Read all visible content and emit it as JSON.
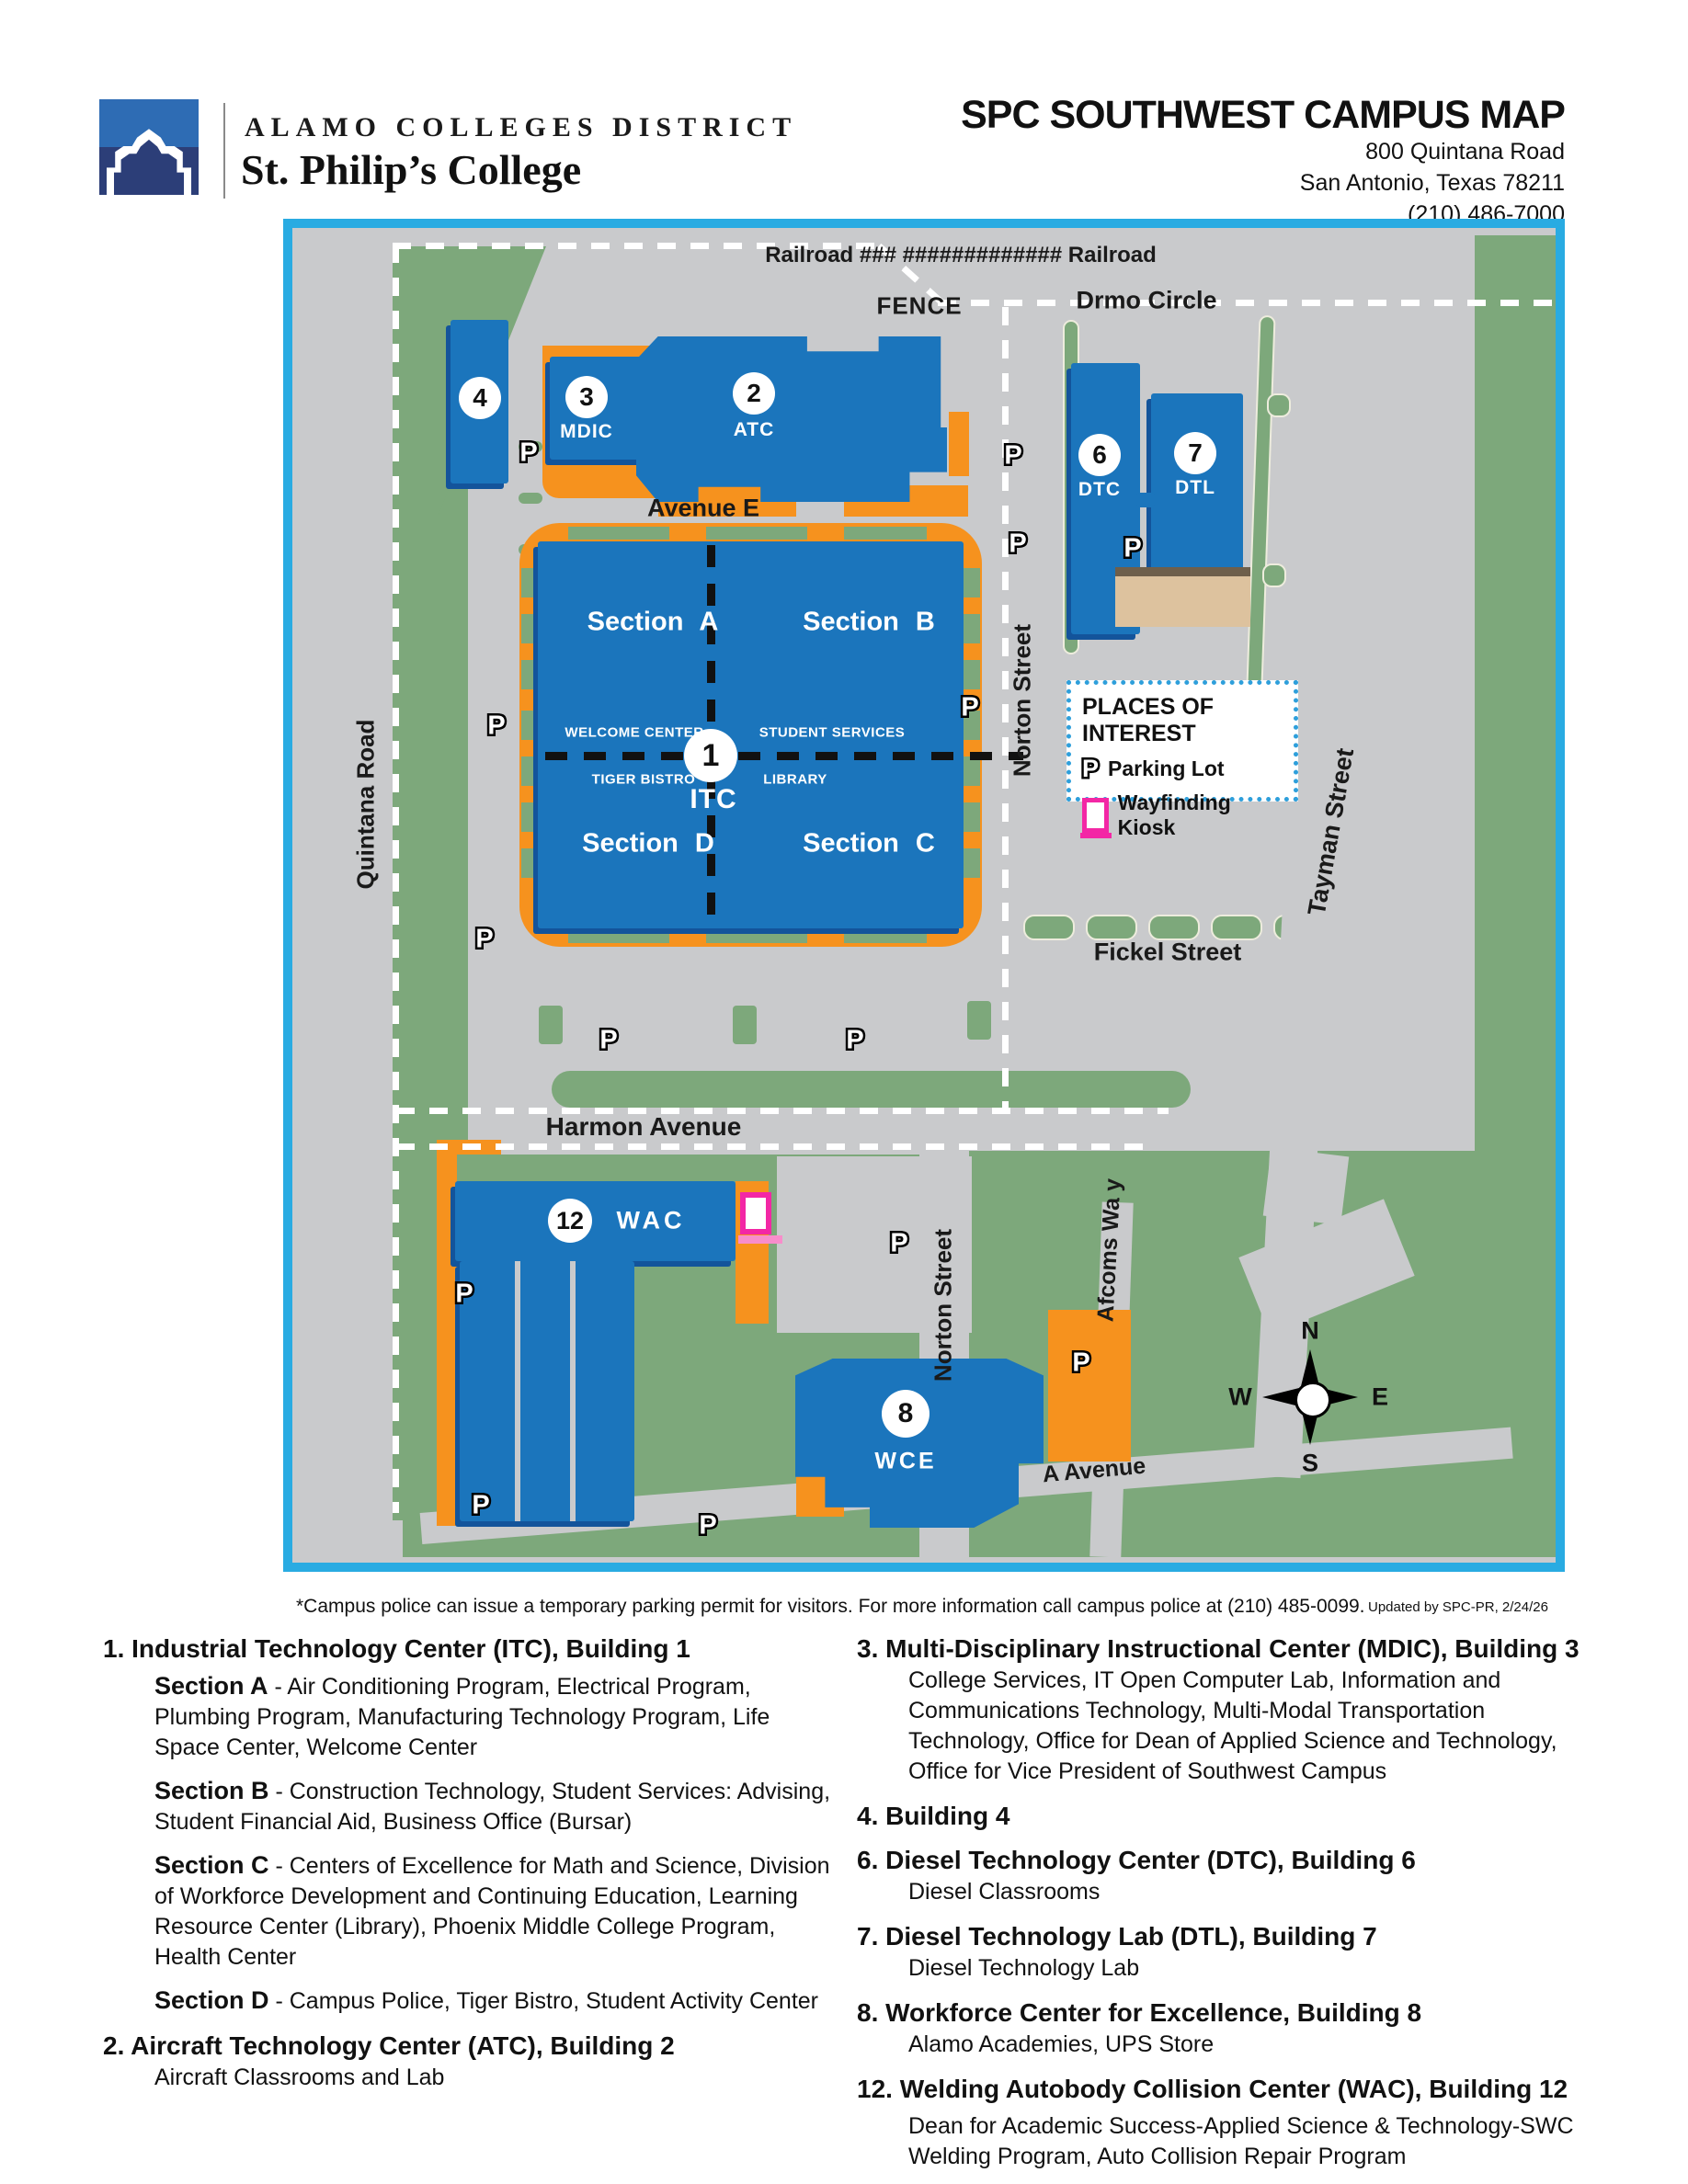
{
  "header": {
    "district": "ALAMO COLLEGES DISTRICT",
    "college": "St. Philip’s College",
    "title": "SPC SOUTHWEST CAMPUS MAP",
    "address_line1": "800 Quintana Road",
    "address_line2": "San Antonio, Texas 78211",
    "address_line3": "(210) 486-7000"
  },
  "map": {
    "p_label": "P",
    "labels": {
      "railroad": "Railroad ### #############   Railroad",
      "fence": "FENCE",
      "drmo_circle": "Drmo Circle",
      "avenue_e": "Avenue  E",
      "quintana_road": "Quintana Road",
      "norton_street_top": "Norton Street",
      "tayman_street": "Tayman Street",
      "fickel_street": "Fickel Street",
      "harmon_avenue": "Harmon Avenue",
      "norton_street_bottom": "Norton Street",
      "afcoms_way": "Afcoms Wa y",
      "a_avenue": "A Avenue"
    },
    "buildings": {
      "b4": {
        "number": "4"
      },
      "mdic": {
        "number": "3",
        "code": "MDIC"
      },
      "atc": {
        "number": "2",
        "code": "ATC"
      },
      "dtc": {
        "number": "6",
        "code": "DTC"
      },
      "dtl": {
        "number": "7",
        "code": "DTL"
      },
      "itc": {
        "number": "1",
        "code": "ITC",
        "section_a": "Section A",
        "section_b": "Section B",
        "section_c": "Section C",
        "section_d": "Section D",
        "welcome_center": "WELCOME CENTER",
        "student_services": "STUDENT SERVICES",
        "tiger_bistro": "TIGER BISTRO",
        "library": "LIBRARY"
      },
      "wac": {
        "number": "12",
        "code": "WAC"
      },
      "wce": {
        "number": "8",
        "code": "WCE"
      }
    },
    "legend": {
      "title": "PLACES OF INTEREST",
      "parking": "Parking Lot",
      "kiosk": "Wayfinding Kiosk"
    },
    "compass": {
      "n": "N",
      "s": "S",
      "e": "E",
      "w": "W"
    },
    "colors": {
      "building_blue": "#1B75BC",
      "building_shadow": "#13549B",
      "parking_orange": "#F6921E",
      "landscape_green": "#7DA87B",
      "road_gray": "#C9CACC",
      "map_border_cyan": "#29ABE2",
      "kiosk_magenta": "#F327A5",
      "tan_building": "#DDC29E"
    }
  },
  "footer": {
    "note": "*Campus police can issue a temporary parking permit for visitors. For more information call campus police at (210) 485-0099.",
    "updated": "Updated by SPC-PR, 2/24/26"
  },
  "directory": {
    "left": [
      {
        "title": "1. Industrial Technology Center (ITC), Building 1",
        "items": [
          {
            "label": "Section A",
            "text": " - Air Conditioning Program, Electrical Program, Plumbing Program, Manufacturing Technology Program, Life Space Center, Welcome Center"
          },
          {
            "label": "Section B",
            "text": " - Construction Technology, Student Services: Advising, Student Financial Aid, Business Office (Bursar)"
          },
          {
            "label": "Section C",
            "text": " - Centers of Excellence for Math and Science, Division of Workforce Development and Continuing Education, Learning Resource Center (Library), Phoenix Middle College Program, Health Center"
          },
          {
            "label": "Section D",
            "text": " - Campus Police, Tiger Bistro, Student Activity Center"
          }
        ]
      },
      {
        "title": "2. Aircraft Technology Center (ATC), Building 2",
        "items": [
          {
            "label": "",
            "text": "Aircraft Classrooms and Lab"
          }
        ]
      }
    ],
    "right": [
      {
        "title": "3. Multi-Disciplinary Instructional Center (MDIC), Building 3",
        "items": [
          {
            "label": "",
            "text": "College Services, IT Open Computer Lab, Information and Communications Technology, Multi-Modal Transportation Technology, Office for Dean of Applied Science and Technology, Office for Vice President of Southwest Campus"
          }
        ]
      },
      {
        "title": "4. Building 4",
        "items": []
      },
      {
        "title": "6. Diesel Technology Center (DTC), Building 6",
        "items": [
          {
            "label": "",
            "text": "Diesel Classrooms"
          }
        ]
      },
      {
        "title": "7. Diesel Technology Lab (DTL), Building 7",
        "items": [
          {
            "label": "",
            "text": "Diesel Technology Lab"
          }
        ]
      },
      {
        "title": "8. Workforce Center for Excellence, Building 8",
        "items": [
          {
            "label": "",
            "text": "Alamo Academies, UPS Store"
          }
        ]
      },
      {
        "title": "12. Welding Autobody Collision Center (WAC), Building 12",
        "items": [
          {
            "label": "",
            "text": "Dean for Academic Success-Applied Science & Technology-SWC Welding Program, Auto Collision Repair Program"
          }
        ]
      }
    ]
  }
}
